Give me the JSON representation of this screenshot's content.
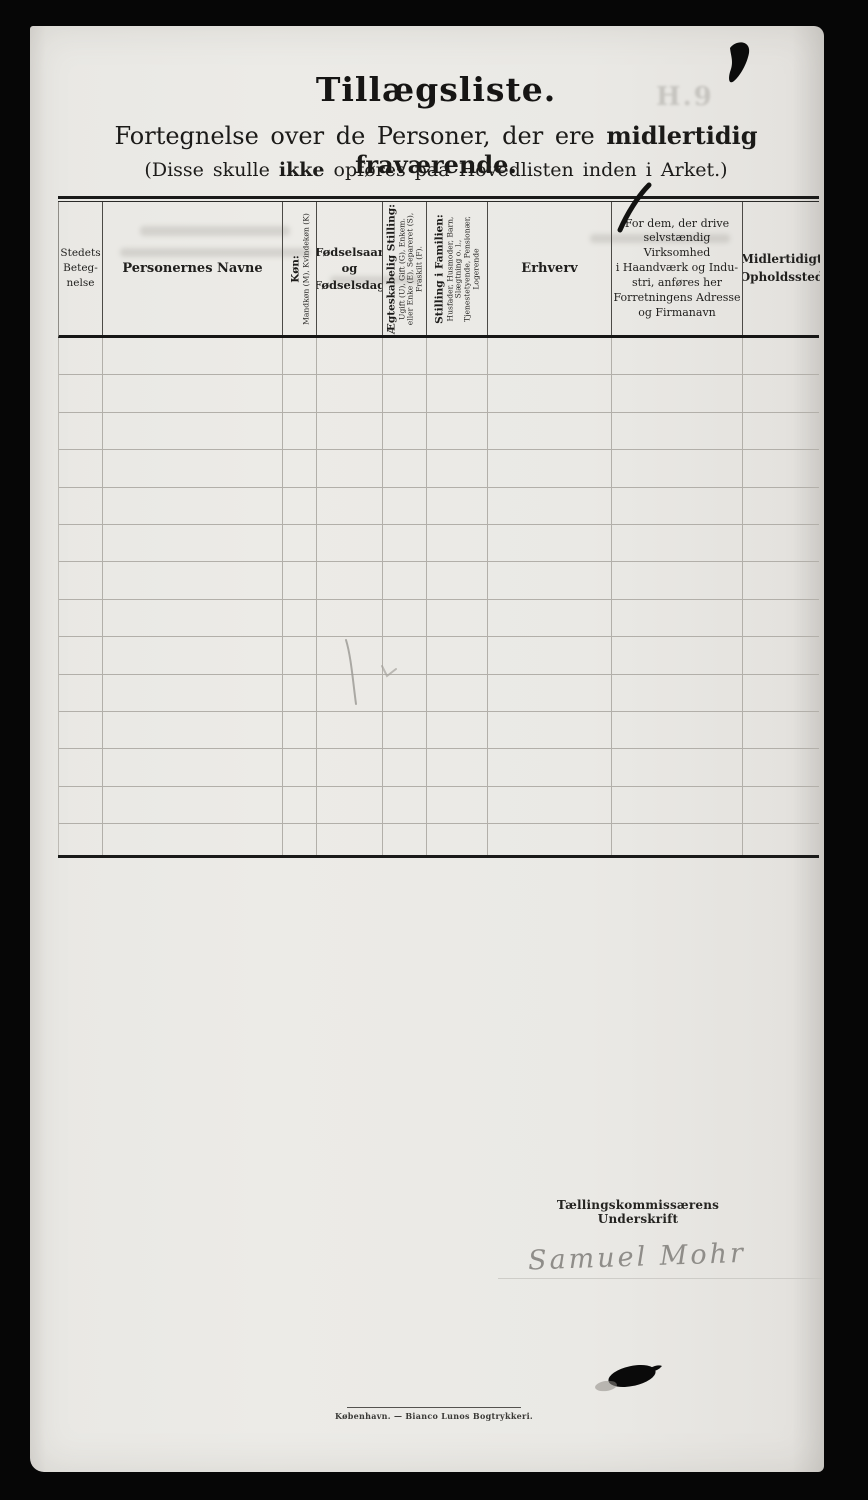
{
  "page": {
    "title": "Tillægsliste.",
    "subtitle": {
      "prefix": "Fortegnelse over de Personer, der ere ",
      "bold": "midlertidig fraværende."
    },
    "note": {
      "prefix": "(Disse skulle ",
      "bold": "ikke",
      "suffix": " opføres paa Hovedlisten inden i Arket.)"
    }
  },
  "table": {
    "row_count": 14,
    "columns": [
      {
        "id": "stedets-betegnelse",
        "label": "Stedets\nBeteg-\nnelse"
      },
      {
        "id": "personernes-navne",
        "label": "Personernes Navne"
      },
      {
        "id": "kon",
        "title": "Køn:",
        "subtitle": "Mandkøn (M), Kvindekøn (K)"
      },
      {
        "id": "fodselsdato",
        "label": "Fødselsaar\nog\nFødselsdag"
      },
      {
        "id": "aegteskabelig-stilling",
        "title": "Ægteskabelig Stilling:",
        "subtitle": "Ugift (U), Gift (G), Enkem.\neller Enke (E), Separeret (S),\nFraskilt (F)."
      },
      {
        "id": "stilling-i-familien",
        "title": "Stilling i Familien:",
        "subtitle": "Husfader, Husmoder, Barn,\nSlægtning o. l.,\nTjenestetyende, Pensionær,\nLogerende"
      },
      {
        "id": "erhverv",
        "label": "Erhverv"
      },
      {
        "id": "virksomhed-note",
        "label": "For dem, der drive\nselvstændig Virksomhed\ni Haandværk og Indu-\nstri, anføres her\nForretningens Adresse\nog Firmanavn"
      },
      {
        "id": "midlertidigt-opholdssted",
        "label": "Midlertidigt\nOpholdssted"
      }
    ]
  },
  "signature": {
    "label": "Tællingskommissærens Underskrift",
    "name": "Samuel Mohr"
  },
  "footer": {
    "imprint": "København. — Bianco Lunos Bogtrykkeri."
  },
  "artifacts": {
    "ghost_text": "H.9"
  },
  "colors": {
    "paper": "#eae9e5",
    "background": "#060606",
    "rule": "#1a1a19",
    "faint_line": "#b2afa9",
    "ink": "#0c0c0c"
  }
}
